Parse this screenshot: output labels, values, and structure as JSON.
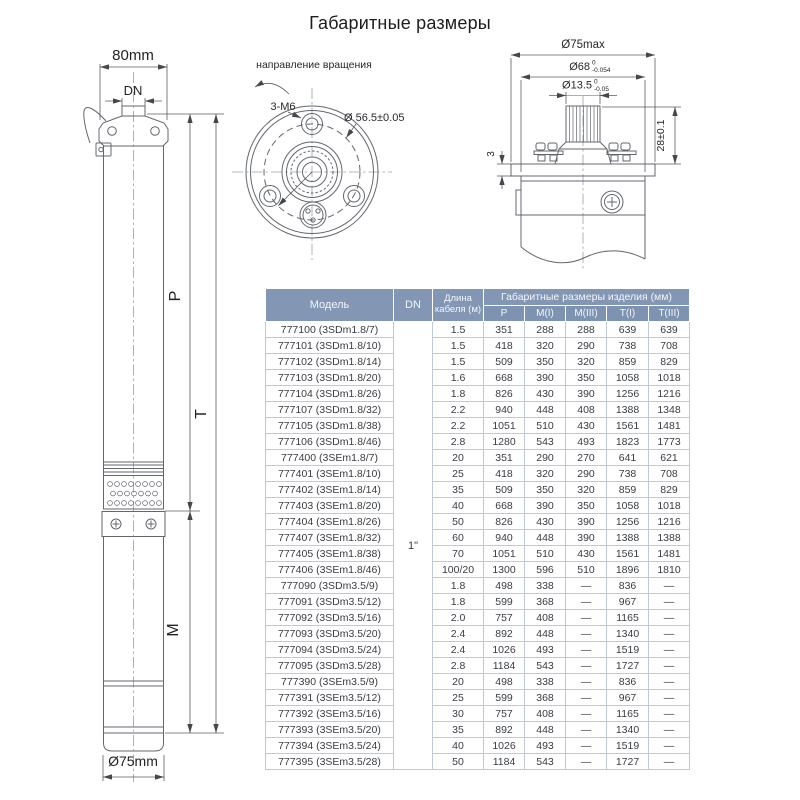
{
  "title": "Габаритные размеры",
  "left_view": {
    "width_label": "80mm",
    "dn_label": "DN",
    "p_label": "P",
    "t_label": "T",
    "m_label": "M",
    "diameter_label": "Ø75mm"
  },
  "top_view": {
    "rotation_label": "направление вращения",
    "bolts_label": "3-M6",
    "bolt_circle_label": "Ø 56.5±0.05"
  },
  "detail_view": {
    "d75_label": "Ø75max",
    "d68_label": "Ø68",
    "d68_tol_upper": "0",
    "d68_tol_lower": "-0.054",
    "d135_label": "Ø13.5",
    "d135_tol_upper": "0",
    "d135_tol_lower": "-0.05",
    "height_label": "28±0.1",
    "plate_label": "3"
  },
  "table": {
    "col_model": "Модель",
    "col_dn": "DN",
    "col_cable": "Длина кабеля (м)",
    "col_group": "Габаритные размеры изделия (мм)",
    "subcols": [
      "P",
      "M(I)",
      "M(III)",
      "T(I)",
      "T(III)"
    ],
    "dn_value": "1\"",
    "rows": [
      [
        "777100 (3SDm1.8/7)",
        "1.5",
        "351",
        "288",
        "288",
        "639",
        "639"
      ],
      [
        "777101 (3SDm1.8/10)",
        "1.5",
        "418",
        "320",
        "290",
        "738",
        "708"
      ],
      [
        "777102 (3SDm1.8/14)",
        "1.5",
        "509",
        "350",
        "320",
        "859",
        "829"
      ],
      [
        "777103 (3SDm1.8/20)",
        "1.6",
        "668",
        "390",
        "350",
        "1058",
        "1018"
      ],
      [
        "777104 (3SDm1.8/26)",
        "1.8",
        "826",
        "430",
        "390",
        "1256",
        "1216"
      ],
      [
        "777107 (3SDm1.8/32)",
        "2.2",
        "940",
        "448",
        "408",
        "1388",
        "1348"
      ],
      [
        "777105 (3SDm1.8/38)",
        "2.2",
        "1051",
        "510",
        "430",
        "1561",
        "1481"
      ],
      [
        "777106 (3SDm1.8/46)",
        "2.8",
        "1280",
        "543",
        "493",
        "1823",
        "1773"
      ],
      [
        "777400 (3SEm1.8/7)",
        "20",
        "351",
        "290",
        "270",
        "641",
        "621"
      ],
      [
        "777401 (3SEm1.8/10)",
        "25",
        "418",
        "320",
        "290",
        "738",
        "708"
      ],
      [
        "777402 (3SEm1.8/14)",
        "35",
        "509",
        "350",
        "320",
        "859",
        "829"
      ],
      [
        "777403 (3SEm1.8/20)",
        "40",
        "668",
        "390",
        "350",
        "1058",
        "1018"
      ],
      [
        "777404 (3SEm1.8/26)",
        "50",
        "826",
        "430",
        "390",
        "1256",
        "1216"
      ],
      [
        "777407 (3SEm1.8/32)",
        "60",
        "940",
        "448",
        "390",
        "1388",
        "1388"
      ],
      [
        "777405 (3SEm1.8/38)",
        "70",
        "1051",
        "510",
        "430",
        "1561",
        "1481"
      ],
      [
        "777406 (3SEm1.8/46)",
        "100/20",
        "1300",
        "596",
        "510",
        "1896",
        "1810"
      ],
      [
        "777090 (3SDm3.5/9)",
        "1.8",
        "498",
        "338",
        "—",
        "836",
        "—"
      ],
      [
        "777091 (3SDm3.5/12)",
        "1.8",
        "599",
        "368",
        "—",
        "967",
        "—"
      ],
      [
        "777092 (3SDm3.5/16)",
        "2.0",
        "757",
        "408",
        "—",
        "1165",
        "—"
      ],
      [
        "777093 (3SDm3.5/20)",
        "2.4",
        "892",
        "448",
        "—",
        "1340",
        "—"
      ],
      [
        "777094 (3SDm3.5/24)",
        "2.4",
        "1026",
        "493",
        "—",
        "1519",
        "—"
      ],
      [
        "777095 (3SDm3.5/28)",
        "2.8",
        "1184",
        "543",
        "—",
        "1727",
        "—"
      ],
      [
        "777390 (3SEm3.5/9)",
        "20",
        "498",
        "338",
        "—",
        "836",
        "—"
      ],
      [
        "777391 (3SEm3.5/12)",
        "25",
        "599",
        "368",
        "—",
        "967",
        "—"
      ],
      [
        "777392 (3SEm3.5/16)",
        "30",
        "757",
        "408",
        "—",
        "1165",
        "—"
      ],
      [
        "777393 (3SEm3.5/20)",
        "35",
        "892",
        "448",
        "—",
        "1340",
        "—"
      ],
      [
        "777394 (3SEm3.5/24)",
        "40",
        "1026",
        "493",
        "—",
        "1519",
        "—"
      ],
      [
        "777395 (3SEm3.5/28)",
        "50",
        "1184",
        "543",
        "—",
        "1727",
        "—"
      ]
    ]
  },
  "colors": {
    "header_bg": "#8397b4",
    "header_sub_bg": "#7e93b2",
    "header_text": "#f3f6fa",
    "table_border": "#bccbd9",
    "body_text": "#383c42",
    "drawing_line": "#63676d"
  }
}
